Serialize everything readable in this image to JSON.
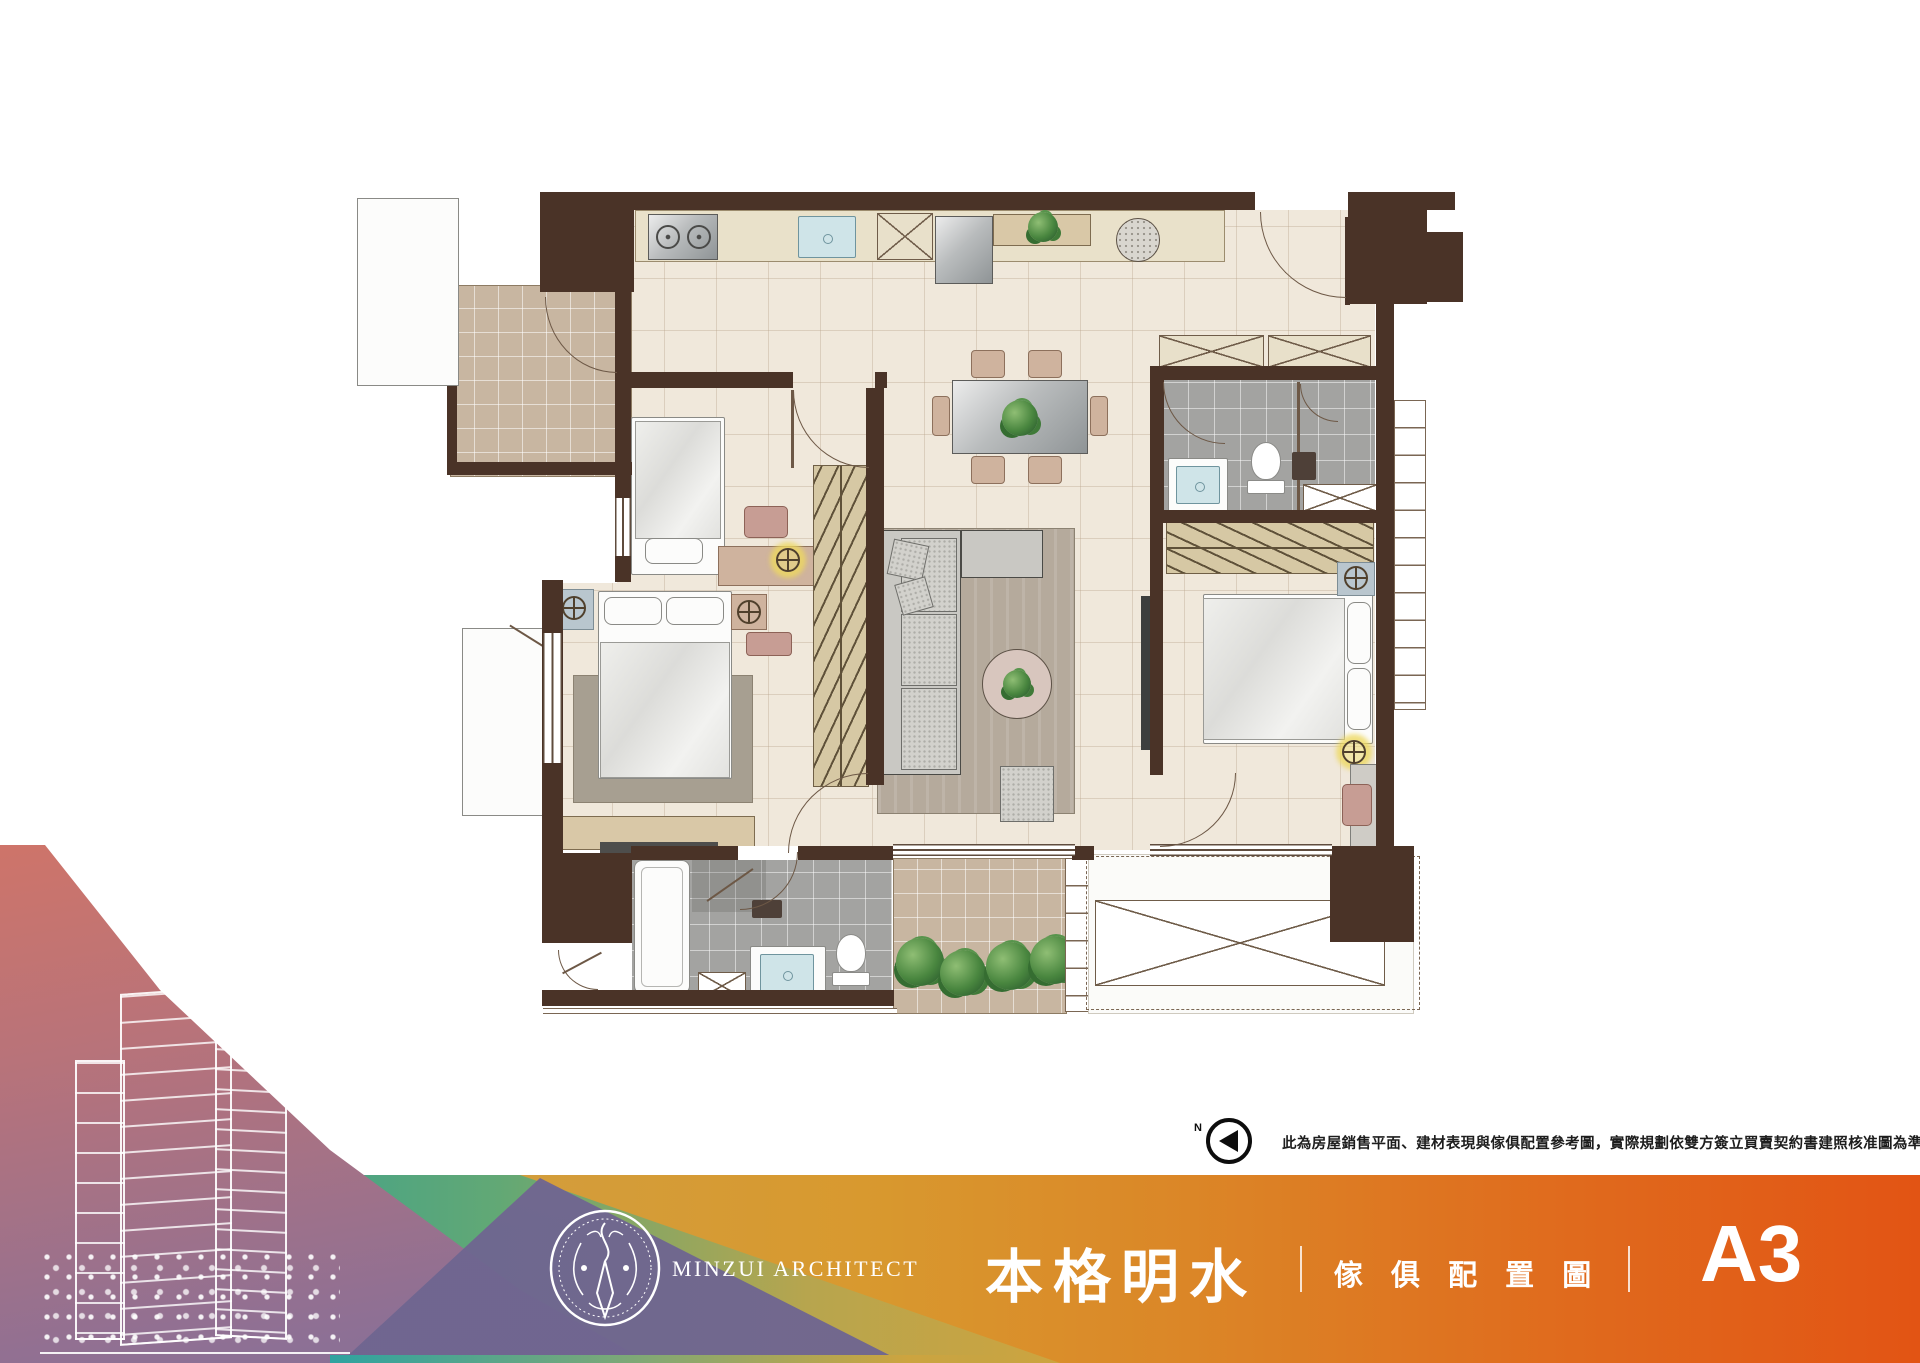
{
  "sheet": {
    "compass_label": "N",
    "disclaimer": "此為房屋銷售平面、建材表現與傢俱配置參考圖，實際規劃依雙方簽立買賣契約書建照核准圖為準"
  },
  "footer": {
    "brand_en": "MINZUI ARCHITECT",
    "project_name": "本格明水",
    "drawing_type": "傢 俱 配 置 圖",
    "unit_label": "A3"
  },
  "colors": {
    "wall_brown": "#4a3327",
    "floor_cream": "#f0e8db",
    "tile_tan": "#c8b6a1",
    "tile_gray": "#a3a3a1",
    "counter_beige": "#e9e1ca",
    "wood": "#d9c8a7",
    "water_blue": "#cfe4e8",
    "plant_green": "#49863f",
    "gold": "#d8992f",
    "accent_orange": "#e25414",
    "teal": "#3ba18e",
    "purple": "#7e6b94",
    "salmon": "#e2734c"
  },
  "icons": {
    "compass": "north-arrow-icon",
    "emblem": "brand-emblem-icon",
    "building": "building-sketch-icon"
  }
}
